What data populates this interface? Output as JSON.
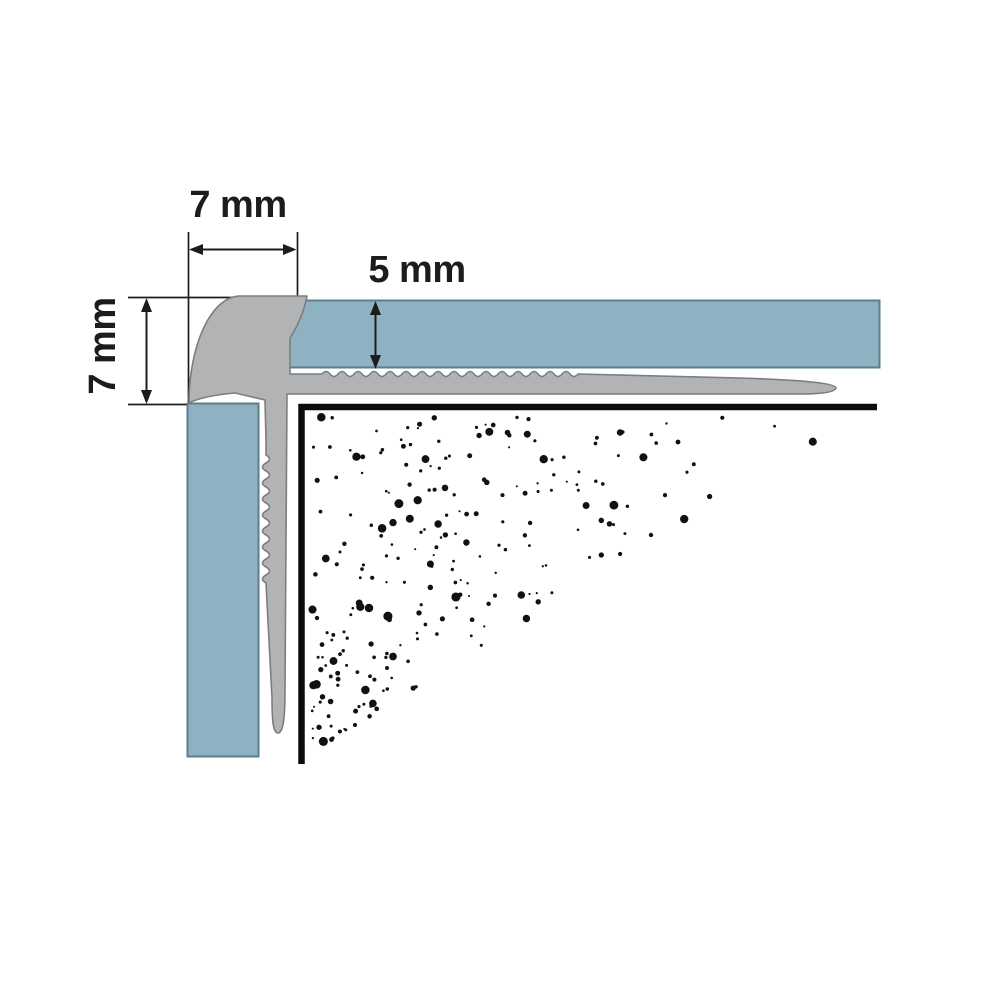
{
  "diagram": {
    "labels": {
      "top_width": "7 mm",
      "riser_height": "7 mm",
      "tile_thickness": "5 mm"
    },
    "colors": {
      "background": "#ffffff",
      "tile_fill": "#8db2c1",
      "tile_border": "#5e7d8b",
      "profile_fill": "#b2b3b5",
      "profile_outline": "#7c7d7f",
      "line_color": "#1c1c1c",
      "substrate_line": "#0b0b0b",
      "stipple_dot": "#111111"
    },
    "stipple": {
      "dot_count": 250,
      "seed": 13
    }
  }
}
